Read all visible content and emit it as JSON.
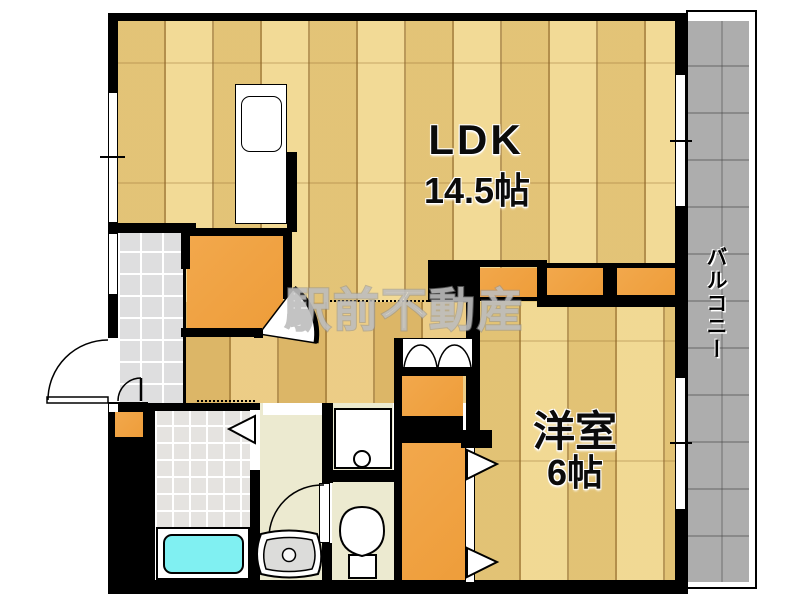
{
  "plan": {
    "watermark": "駅前不動産",
    "rooms": {
      "ldk": {
        "label": "LDK",
        "size": "14.5帖"
      },
      "bedroom": {
        "label": "洋室",
        "size": "6帖"
      },
      "balcony": {
        "label": "バルコニー"
      }
    },
    "colors": {
      "wall": "#000000",
      "wood_floor": "#edd186",
      "hall_wood": "#e4bf70",
      "closet_orange": "#f0a344",
      "genkan_tile": "#dededf",
      "bathroom_tile": "#e5e3e0",
      "wet_area_floor": "#ecead0",
      "balcony_concrete": "#adadad",
      "bathtub": "#80f0f2",
      "basin_gray": "#dcdcda"
    }
  }
}
